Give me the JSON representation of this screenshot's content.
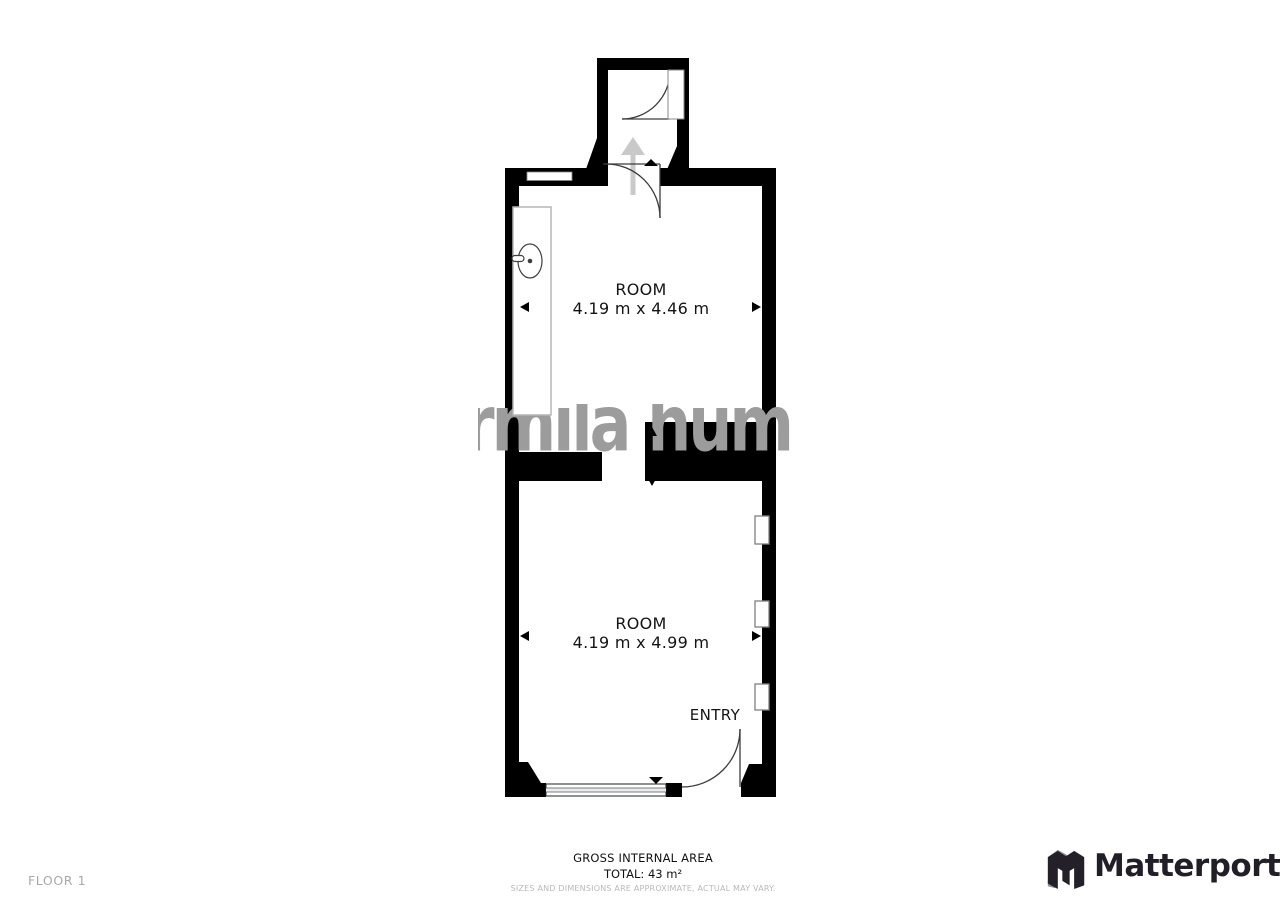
{
  "floor_label": "FLOOR 1",
  "rooms": [
    {
      "name": "ROOM",
      "dimensions": "4.19 m x 4.46 m"
    },
    {
      "name": "ROOM",
      "dimensions": "4.19 m x 4.99 m"
    }
  ],
  "entry_label": "ENTRY",
  "watermark_text": "rmila hum",
  "footer": {
    "gross_area_label": "GROSS INTERNAL AREA",
    "total": "TOTAL: 43 m²",
    "disclaimer": "SIZES AND DIMENSIONS ARE APPROXIMATE, ACTUAL MAY VARY."
  },
  "branding": {
    "logo_text": "Matterport",
    "logo_icon": "matterport-m-icon"
  },
  "colors": {
    "wall": "#000000",
    "watermark": "#9c9c9c",
    "logo": "#221e28",
    "muted": "#a8a8a8",
    "faint": "#b9b9b9",
    "window_fill": "#e9ebf3",
    "arrow_gray": "#c9c9c9"
  }
}
